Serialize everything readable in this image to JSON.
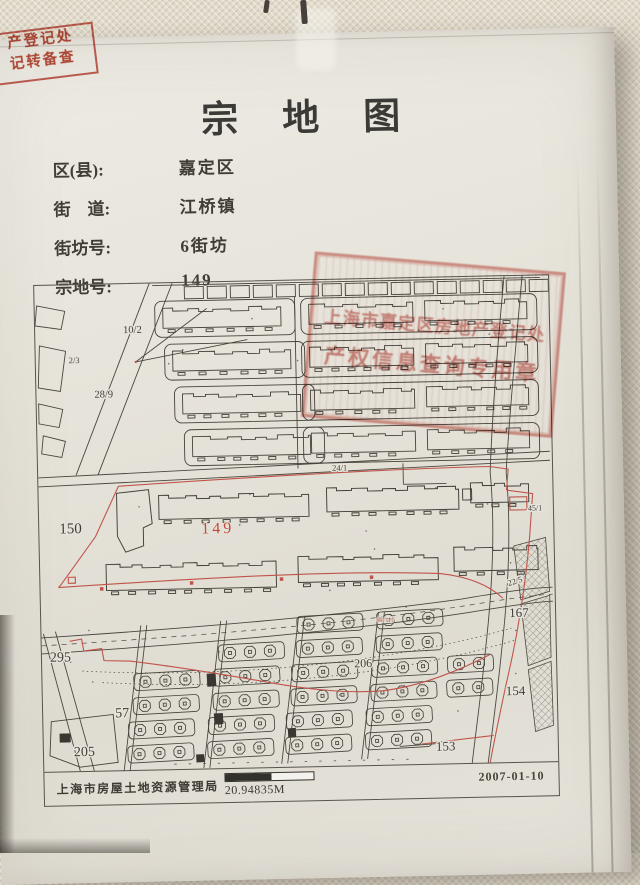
{
  "title": "宗地图",
  "corner_stamp": {
    "line1": "产登记处",
    "line2": "记转备查"
  },
  "form": {
    "rows": [
      {
        "label": "区(县):",
        "value": "嘉定区"
      },
      {
        "label": "街　道:",
        "value": "江桥镇"
      },
      {
        "label": "街坊号:",
        "value": "6街坊"
      },
      {
        "label": "宗地号:",
        "value": "149"
      }
    ]
  },
  "map": {
    "labels": {
      "l2_3": "2/3",
      "l10_2": "10/2",
      "l28_9": "28/9",
      "l24_1": "24/1",
      "l45_1": "45/1",
      "l22_5": "22/5",
      "l150": "150",
      "l149": "149",
      "l295": "295",
      "l57": "57",
      "l205": "205",
      "l206": "206",
      "l167": "167",
      "l154": "154",
      "l153": "153",
      "village": "春六村"
    },
    "stamp": {
      "line1": "上海市嘉定区房地产登记处",
      "line2": "产权信息查询专用章"
    },
    "footer": {
      "agency": "上海市房屋土地资源管理局",
      "scale_label": "20.94835M",
      "date": "2007-01-10"
    }
  },
  "colors": {
    "boundary_red": "#c0544a",
    "stamp_red": "#c13e30",
    "ink": "#45423b",
    "paper": "#e7e4db"
  }
}
